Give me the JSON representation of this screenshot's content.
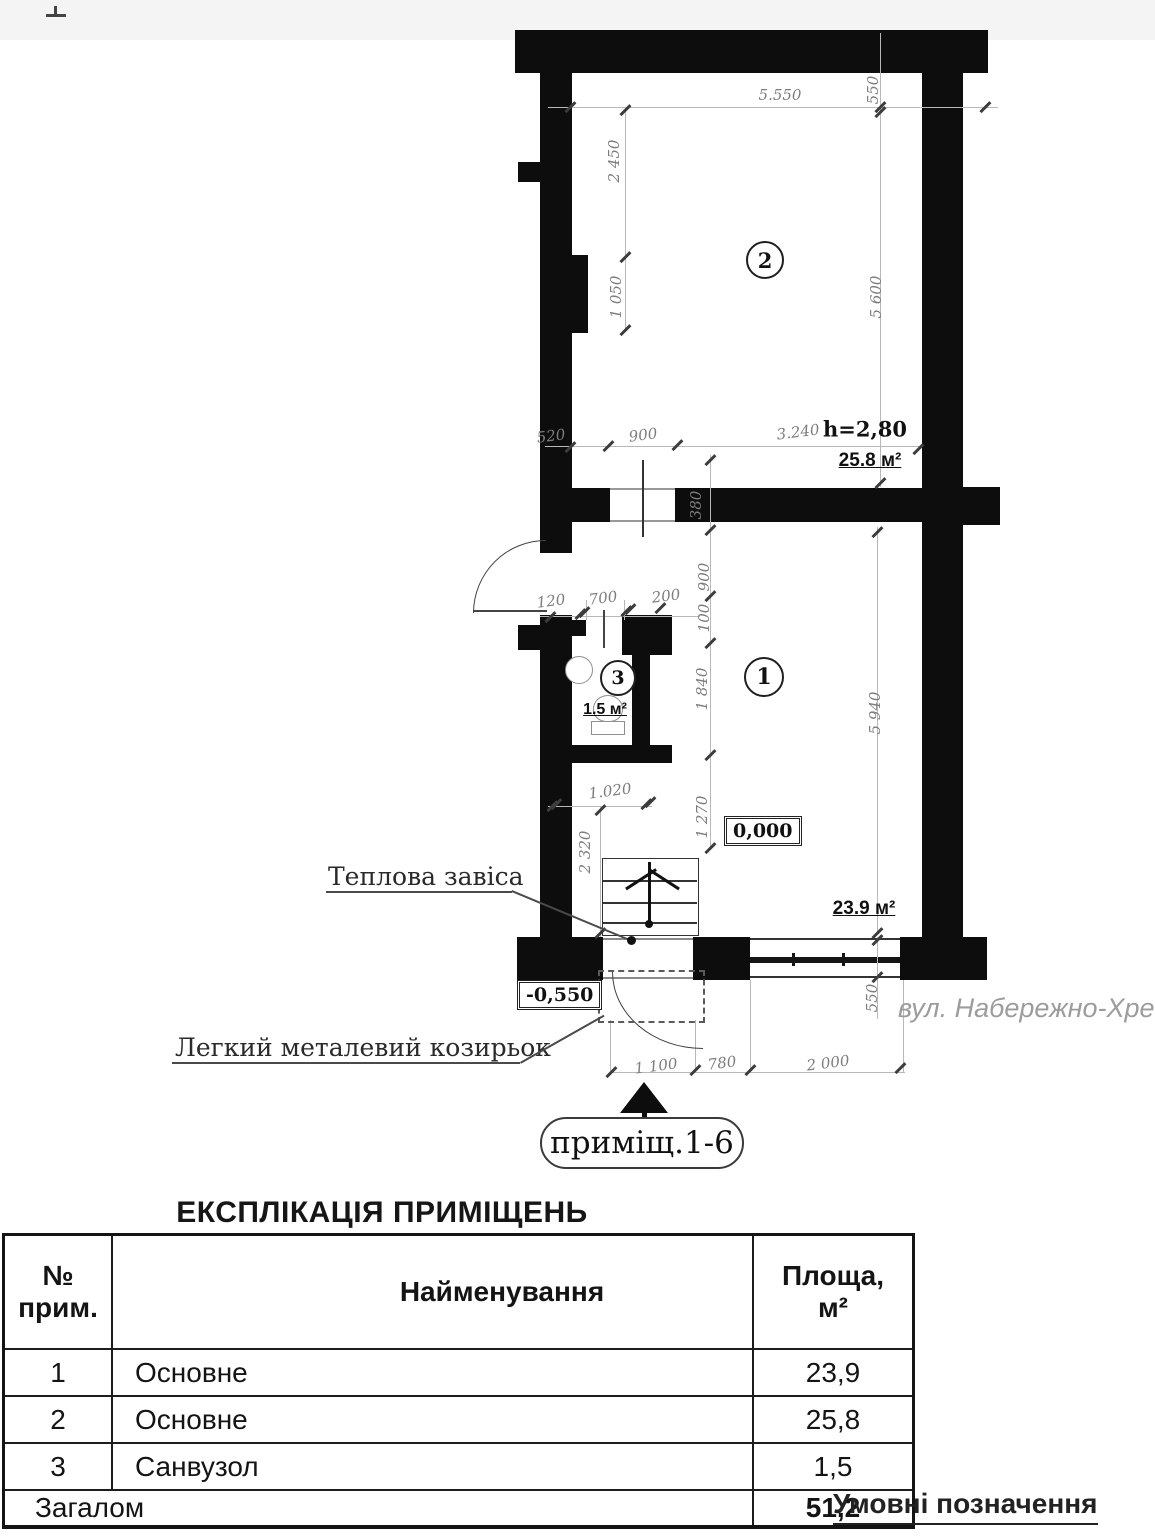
{
  "plan": {
    "street_label": "вул. Набережно-Хрещ",
    "height_note": "h=2,80",
    "stamp_label": "приміщ.1-6",
    "callout_top": "Теплова завіса",
    "callout_bottom": "Легкий металевий козирьок",
    "elevation_inside": "0,000",
    "elevation_outside": "-0,550",
    "rooms": [
      {
        "number": "1",
        "area": "23.9 м²"
      },
      {
        "number": "2",
        "area": "25.8 м²"
      },
      {
        "number": "3",
        "area": "1.5 м²"
      }
    ],
    "dimensions": [
      {
        "label": "5.550",
        "x": 780,
        "y": 95,
        "o": "h"
      },
      {
        "label": "550",
        "x": 873,
        "y": 90,
        "o": "v"
      },
      {
        "label": "2 450",
        "x": 614,
        "y": 161,
        "o": "v"
      },
      {
        "label": "1 050",
        "x": 616,
        "y": 297,
        "o": "v"
      },
      {
        "label": "5 600",
        "x": 876,
        "y": 297,
        "o": "v"
      },
      {
        "label": "520",
        "x": 551,
        "y": 436,
        "o": "s"
      },
      {
        "label": "900",
        "x": 643,
        "y": 435,
        "o": "s"
      },
      {
        "label": "3.240",
        "x": 798,
        "y": 432,
        "o": "s"
      },
      {
        "label": "380",
        "x": 696,
        "y": 505,
        "o": "v"
      },
      {
        "label": "900",
        "x": 704,
        "y": 577,
        "o": "v"
      },
      {
        "label": "100",
        "x": 704,
        "y": 618,
        "o": "v"
      },
      {
        "label": "1 840",
        "x": 702,
        "y": 689,
        "o": "v"
      },
      {
        "label": "1 270",
        "x": 702,
        "y": 817,
        "o": "v"
      },
      {
        "label": "120",
        "x": 551,
        "y": 601,
        "o": "s"
      },
      {
        "label": "700",
        "x": 603,
        "y": 598,
        "o": "s"
      },
      {
        "label": "200",
        "x": 666,
        "y": 596,
        "o": "s"
      },
      {
        "label": "1.020",
        "x": 610,
        "y": 791,
        "o": "s"
      },
      {
        "label": "2 320",
        "x": 585,
        "y": 852,
        "o": "v"
      },
      {
        "label": "5 940",
        "x": 875,
        "y": 713,
        "o": "v"
      },
      {
        "label": "550",
        "x": 872,
        "y": 998,
        "o": "v"
      },
      {
        "label": "1 100",
        "x": 656,
        "y": 1066,
        "o": "s"
      },
      {
        "label": "780",
        "x": 722,
        "y": 1063,
        "o": "s"
      },
      {
        "label": "2 000",
        "x": 828,
        "y": 1063,
        "o": "s"
      }
    ]
  },
  "table": {
    "heading": "ЕКСПЛІКАЦІЯ ПРИМІЩЕНЬ",
    "col1_line1": "№",
    "col1_line2": "прим.",
    "col2": "Найменування",
    "col3_line1": "Площа,",
    "col3_line2": "м²",
    "rows": [
      {
        "num": "1",
        "name": "Основне",
        "area": "23,9"
      },
      {
        "num": "2",
        "name": "Основне",
        "area": "25,8"
      },
      {
        "num": "3",
        "name": "Санвузол",
        "area": "1,5"
      }
    ],
    "total_label": "Загалом",
    "total_value": "51,2"
  },
  "legend_title": "Умовні позначення"
}
